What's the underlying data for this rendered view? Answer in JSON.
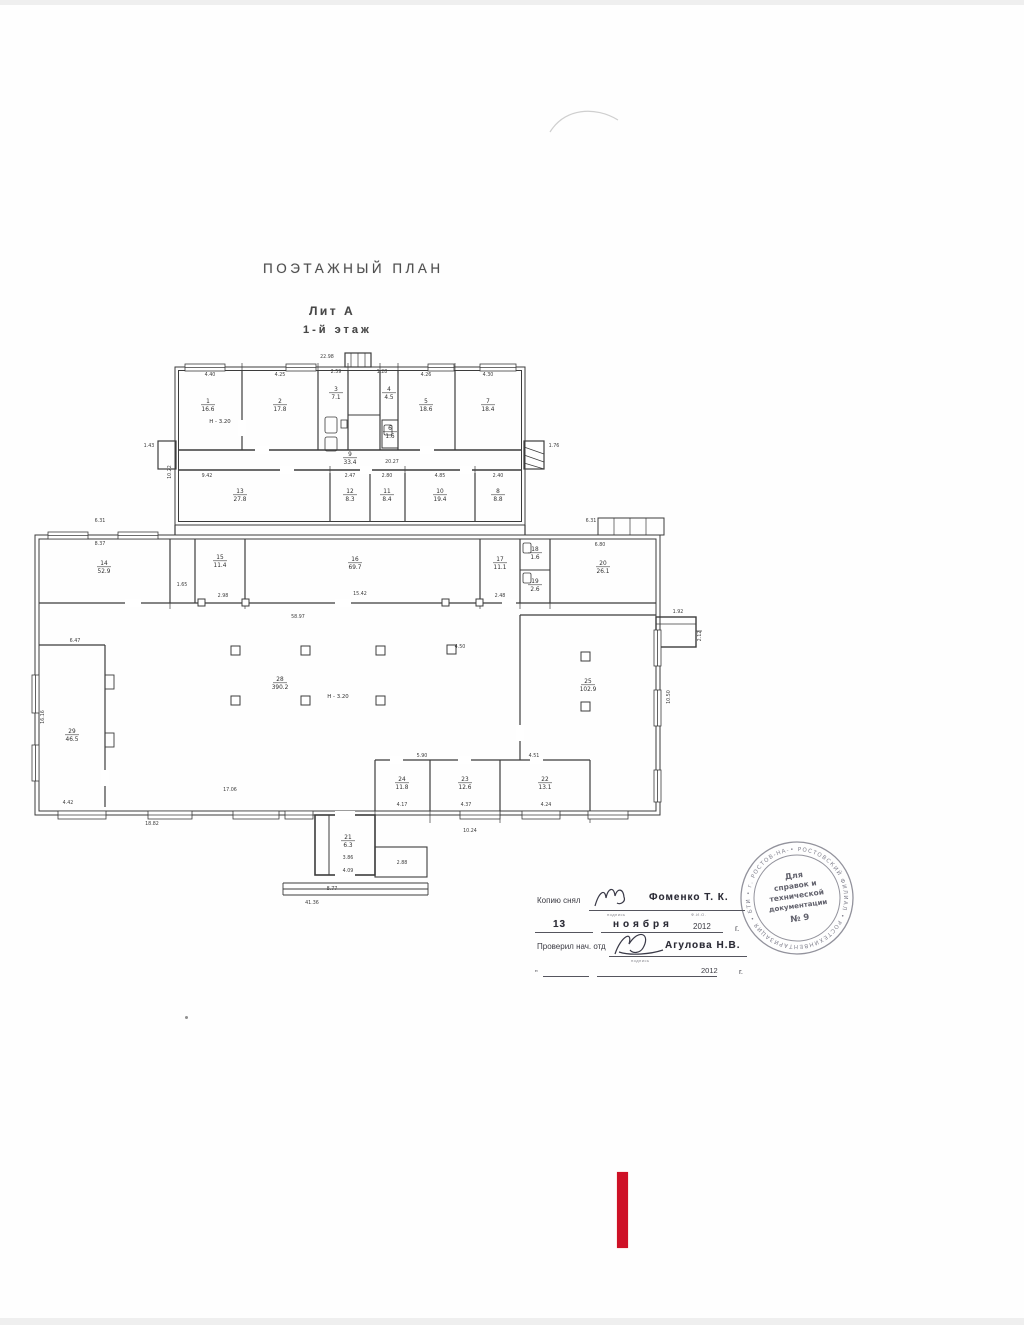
{
  "header": {
    "title": "ПОЭТАЖНЫЙ  ПЛАН",
    "litera": "Лит А",
    "floor": "1-й этаж"
  },
  "plan": {
    "rooms": [
      {
        "num": "1",
        "area": "16.6",
        "x": 178,
        "y": 58
      },
      {
        "num": "2",
        "area": "17.8",
        "x": 250,
        "y": 58
      },
      {
        "num": "3",
        "area": "7.1",
        "x": 306,
        "y": 46
      },
      {
        "num": "4",
        "area": "4.5",
        "x": 359,
        "y": 46
      },
      {
        "num": "6",
        "area": "1.6",
        "x": 360,
        "y": 85
      },
      {
        "num": "5",
        "area": "18.6",
        "x": 396,
        "y": 58
      },
      {
        "num": "7",
        "area": "18.4",
        "x": 458,
        "y": 58
      },
      {
        "num": "9",
        "area": "33.4",
        "x": 320,
        "y": 111
      },
      {
        "num": "13",
        "area": "27.8",
        "x": 210,
        "y": 148
      },
      {
        "num": "12",
        "area": "8.3",
        "x": 320,
        "y": 148
      },
      {
        "num": "11",
        "area": "8.4",
        "x": 357,
        "y": 148
      },
      {
        "num": "10",
        "area": "19.4",
        "x": 410,
        "y": 148
      },
      {
        "num": "8",
        "area": "8.8",
        "x": 468,
        "y": 148
      },
      {
        "num": "14",
        "area": "52.9",
        "x": 74,
        "y": 220
      },
      {
        "num": "15",
        "area": "11.4",
        "x": 190,
        "y": 214
      },
      {
        "num": "16",
        "area": "69.7",
        "x": 325,
        "y": 216
      },
      {
        "num": "17",
        "area": "11.1",
        "x": 470,
        "y": 216
      },
      {
        "num": "18",
        "area": "1.6",
        "x": 505,
        "y": 206
      },
      {
        "num": "19",
        "area": "2.6",
        "x": 505,
        "y": 238
      },
      {
        "num": "20",
        "area": "26.1",
        "x": 573,
        "y": 220
      },
      {
        "num": "29",
        "area": "46.5",
        "x": 42,
        "y": 388
      },
      {
        "num": "28",
        "area": "390.2",
        "x": 250,
        "y": 336
      },
      {
        "num": "25",
        "area": "102.9",
        "x": 558,
        "y": 338
      },
      {
        "num": "24",
        "area": "11.8",
        "x": 372,
        "y": 436
      },
      {
        "num": "23",
        "area": "12.6",
        "x": 435,
        "y": 436
      },
      {
        "num": "22",
        "area": "13.1",
        "x": 515,
        "y": 436
      },
      {
        "num": "21",
        "area": "6.3",
        "x": 318,
        "y": 494
      }
    ],
    "notes": [
      {
        "t": "Н - 3.20",
        "x": 190,
        "y": 78
      },
      {
        "t": "Н - 3.20",
        "x": 308,
        "y": 353
      }
    ],
    "dims": [
      {
        "t": "22.98",
        "x": 297,
        "y": 13
      },
      {
        "t": "4.40",
        "x": 180,
        "y": 31
      },
      {
        "t": "4.25",
        "x": 250,
        "y": 31
      },
      {
        "t": "2.59",
        "x": 306,
        "y": 28
      },
      {
        "t": "1.28",
        "x": 352,
        "y": 28
      },
      {
        "t": "4.26",
        "x": 396,
        "y": 31
      },
      {
        "t": "4.30",
        "x": 458,
        "y": 31
      },
      {
        "t": "1.43",
        "x": 119,
        "y": 102
      },
      {
        "t": "1.76",
        "x": 524,
        "y": 102
      },
      {
        "t": "10.22",
        "x": 141,
        "y": 127,
        "r": -90
      },
      {
        "t": "9.42",
        "x": 177,
        "y": 132
      },
      {
        "t": "20.27",
        "x": 362,
        "y": 118
      },
      {
        "t": "2.47",
        "x": 320,
        "y": 132
      },
      {
        "t": "2.80",
        "x": 357,
        "y": 132
      },
      {
        "t": "4.85",
        "x": 410,
        "y": 132
      },
      {
        "t": "2.40",
        "x": 468,
        "y": 132
      },
      {
        "t": "6.31",
        "x": 70,
        "y": 177
      },
      {
        "t": "6.31",
        "x": 561,
        "y": 177
      },
      {
        "t": "8.37",
        "x": 70,
        "y": 200
      },
      {
        "t": "6.80",
        "x": 570,
        "y": 201
      },
      {
        "t": "1.65",
        "x": 152,
        "y": 241
      },
      {
        "t": "2.98",
        "x": 193,
        "y": 252
      },
      {
        "t": "15.42",
        "x": 330,
        "y": 250
      },
      {
        "t": "2.48",
        "x": 470,
        "y": 252
      },
      {
        "t": "6.47",
        "x": 45,
        "y": 297
      },
      {
        "t": "58.97",
        "x": 268,
        "y": 273
      },
      {
        "t": "4.50",
        "x": 430,
        "y": 303
      },
      {
        "t": "1.92",
        "x": 648,
        "y": 268
      },
      {
        "t": "2.12",
        "x": 671,
        "y": 291,
        "r": -90
      },
      {
        "t": "10.50",
        "x": 640,
        "y": 352,
        "r": -90
      },
      {
        "t": "16.16",
        "x": 14,
        "y": 372,
        "r": -90
      },
      {
        "t": "17.06",
        "x": 200,
        "y": 446
      },
      {
        "t": "4.42",
        "x": 38,
        "y": 459
      },
      {
        "t": "5.90",
        "x": 392,
        "y": 412
      },
      {
        "t": "4.51",
        "x": 504,
        "y": 412
      },
      {
        "t": "4.17",
        "x": 372,
        "y": 461
      },
      {
        "t": "4.37",
        "x": 436,
        "y": 461
      },
      {
        "t": "4.24",
        "x": 516,
        "y": 461
      },
      {
        "t": "18.82",
        "x": 122,
        "y": 480
      },
      {
        "t": "10.24",
        "x": 440,
        "y": 487
      },
      {
        "t": "3.86",
        "x": 318,
        "y": 514
      },
      {
        "t": "4.09",
        "x": 318,
        "y": 527
      },
      {
        "t": "2.88",
        "x": 372,
        "y": 519
      },
      {
        "t": "8.77",
        "x": 302,
        "y": 545
      },
      {
        "t": "41.36",
        "x": 282,
        "y": 559
      }
    ]
  },
  "stamp": {
    "center_lines": [
      "Для",
      "справок и",
      "технической",
      "документации",
      "№ 9"
    ],
    "ring_text": "• РОСТОВСКИЙ ФИЛИАЛ • РОСТЕХИНВЕНТАРИЗАЦИЯ • БТИ • г. РОСТОВ-НА-ДОНУ •"
  },
  "signatures": {
    "row1_label": "Копию снял",
    "row1_name": "Фоменко Т. К.",
    "row2_day": "13",
    "row2_month": "ноября",
    "row2_year": "2012",
    "year_suffix": "г.",
    "row3_label": "Проверил нач. отд",
    "row3_name": "Агулова Н.В.",
    "row4_year": "2012",
    "row4_tick": "„",
    "micro_sign": "подпись",
    "micro_fio": "Ф.И.О."
  }
}
